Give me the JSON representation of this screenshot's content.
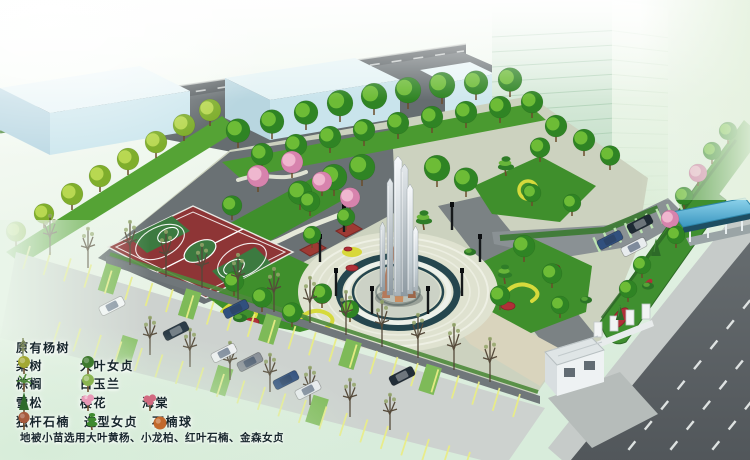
{
  "legend": {
    "items": [
      {
        "label": "原有杨树",
        "icon": "existing-poplar-icon",
        "color": "#7e8a5a"
      },
      {
        "label": "栾树",
        "icon": "koelreuteria-icon",
        "color": "#a2a832"
      },
      {
        "label": "大叶女贞",
        "icon": "glossy-privet-icon",
        "color": "#3e7a2e"
      },
      {
        "label": "棕榈",
        "icon": "palm-icon",
        "color": "#4e8a3a"
      },
      {
        "label": "白玉兰",
        "icon": "magnolia-icon",
        "color": "#8ab450"
      },
      {
        "label": "雪松",
        "icon": "cedar-icon",
        "color": "#2e6b2a"
      },
      {
        "label": "樱花",
        "icon": "cherry-blossom-icon",
        "color": "#e899b7"
      },
      {
        "label": "海棠",
        "icon": "crabapple-icon",
        "color": "#d16a80"
      },
      {
        "label": "独杆石楠",
        "icon": "photinia-standard-icon",
        "color": "#a65a3c"
      },
      {
        "label": "造型女贞",
        "icon": "topiary-privet-icon",
        "color": "#3e8a2e"
      },
      {
        "label": "石楠球",
        "icon": "photinia-ball-icon",
        "color": "#c2682c"
      }
    ],
    "note": "地被小苗选用大叶黄杨、小龙柏、红叶石楠、金森女贞"
  },
  "scene": {
    "palette": {
      "lawn": "#3f8f2c",
      "court_red": "#8e3536",
      "court_green": "#3c7a40",
      "plaza_ring_teal": "#25464e",
      "road_gray": "#5a6164",
      "building_glass_green": "#cfe8d4",
      "low_building_cyan": "#cde7ee",
      "shelter_roof_blue": "#55b2d8",
      "flower_red": "#b03038",
      "hedge_yellow": "#d6da3c",
      "monument_steel": "#c9d2d8",
      "monument_copper": "#b5795a"
    }
  }
}
